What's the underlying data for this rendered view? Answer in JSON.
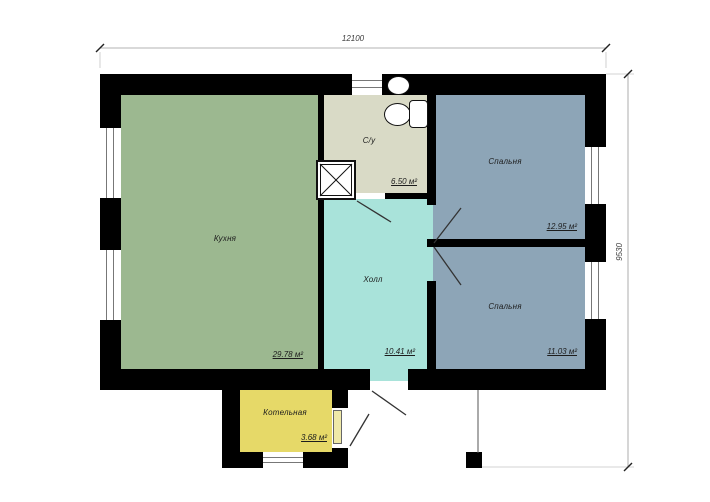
{
  "plan": {
    "type": "floor-plan",
    "dimensions": {
      "width_label": "12100",
      "height_label": "9530"
    },
    "rooms": {
      "kitchen": {
        "label": "Кухня",
        "area": "29.78 м²"
      },
      "bathroom": {
        "label": "С/у",
        "area": "6.50 м²"
      },
      "hall": {
        "label": "Холл",
        "area": "10.41 м²"
      },
      "bedroom_top": {
        "label": "Спальня",
        "area": "12.95 м²"
      },
      "bedroom_bottom": {
        "label": "Спальня",
        "area": "11.03 м²"
      },
      "boiler": {
        "label": "Котельная",
        "area": "3.68 м²"
      }
    },
    "fixtures": [
      "shower-tray-icon",
      "toilet-icon",
      "sink-icon"
    ],
    "windows": {
      "left": 2,
      "right": 2,
      "top": 1,
      "bottom": 1
    }
  },
  "colors": {
    "wall": "#000000",
    "kitchen": "#9cb890",
    "bathroom": "#d9dac6",
    "hall": "#a9e3da",
    "bedroom": "#8da5b7",
    "boiler": "#e6d968",
    "boiler_door": "#efe9a8",
    "swing_line": "#333333",
    "dim_line": "#999999"
  }
}
